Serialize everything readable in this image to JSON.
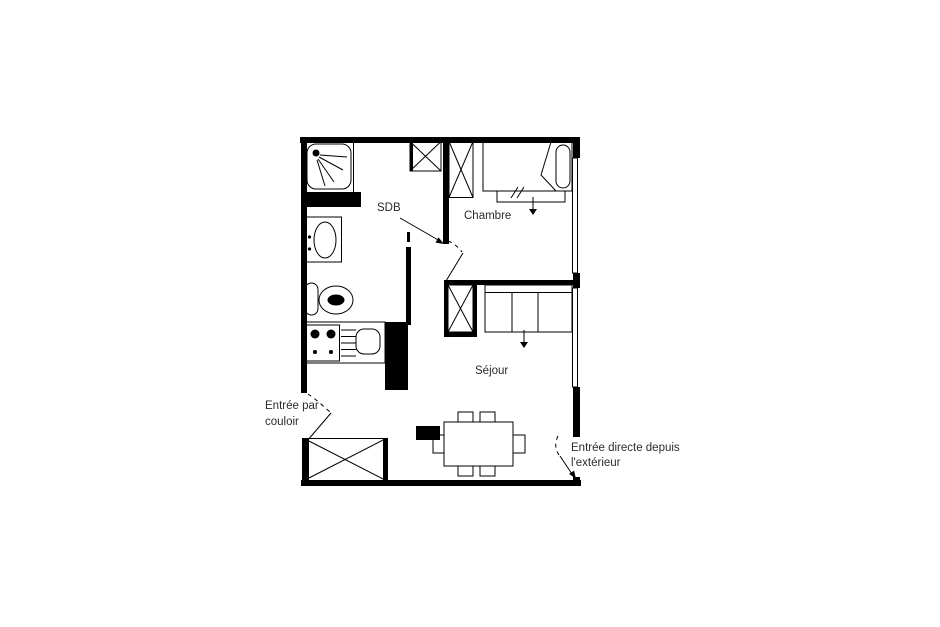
{
  "canvas": {
    "background": "#ffffff",
    "ink_color": "#000000",
    "text_color": "#2b2b2b"
  },
  "labels": {
    "bathroom": "SDB",
    "bedroom": "Chambre",
    "living_room": "Séjour",
    "entry_corridor": {
      "line1": "Entrée par",
      "line2": "couloir"
    },
    "entry_direct": {
      "line1": "Entrée directe depuis",
      "line2": "l'extérieur"
    }
  },
  "fixtures": [
    "shower",
    "washbasin",
    "toilet",
    "stove",
    "kitchen-sink",
    "wardrobe-bathroom",
    "wardrobe-bedroom",
    "bed",
    "bed-drawer",
    "wardrobe-living",
    "sofa-bed",
    "dining-table",
    "chairs",
    "wardrobe-entry",
    "radiator",
    "window-bedroom",
    "window-living",
    "door-entry-corridor",
    "door-entry-direct",
    "door-inner"
  ]
}
